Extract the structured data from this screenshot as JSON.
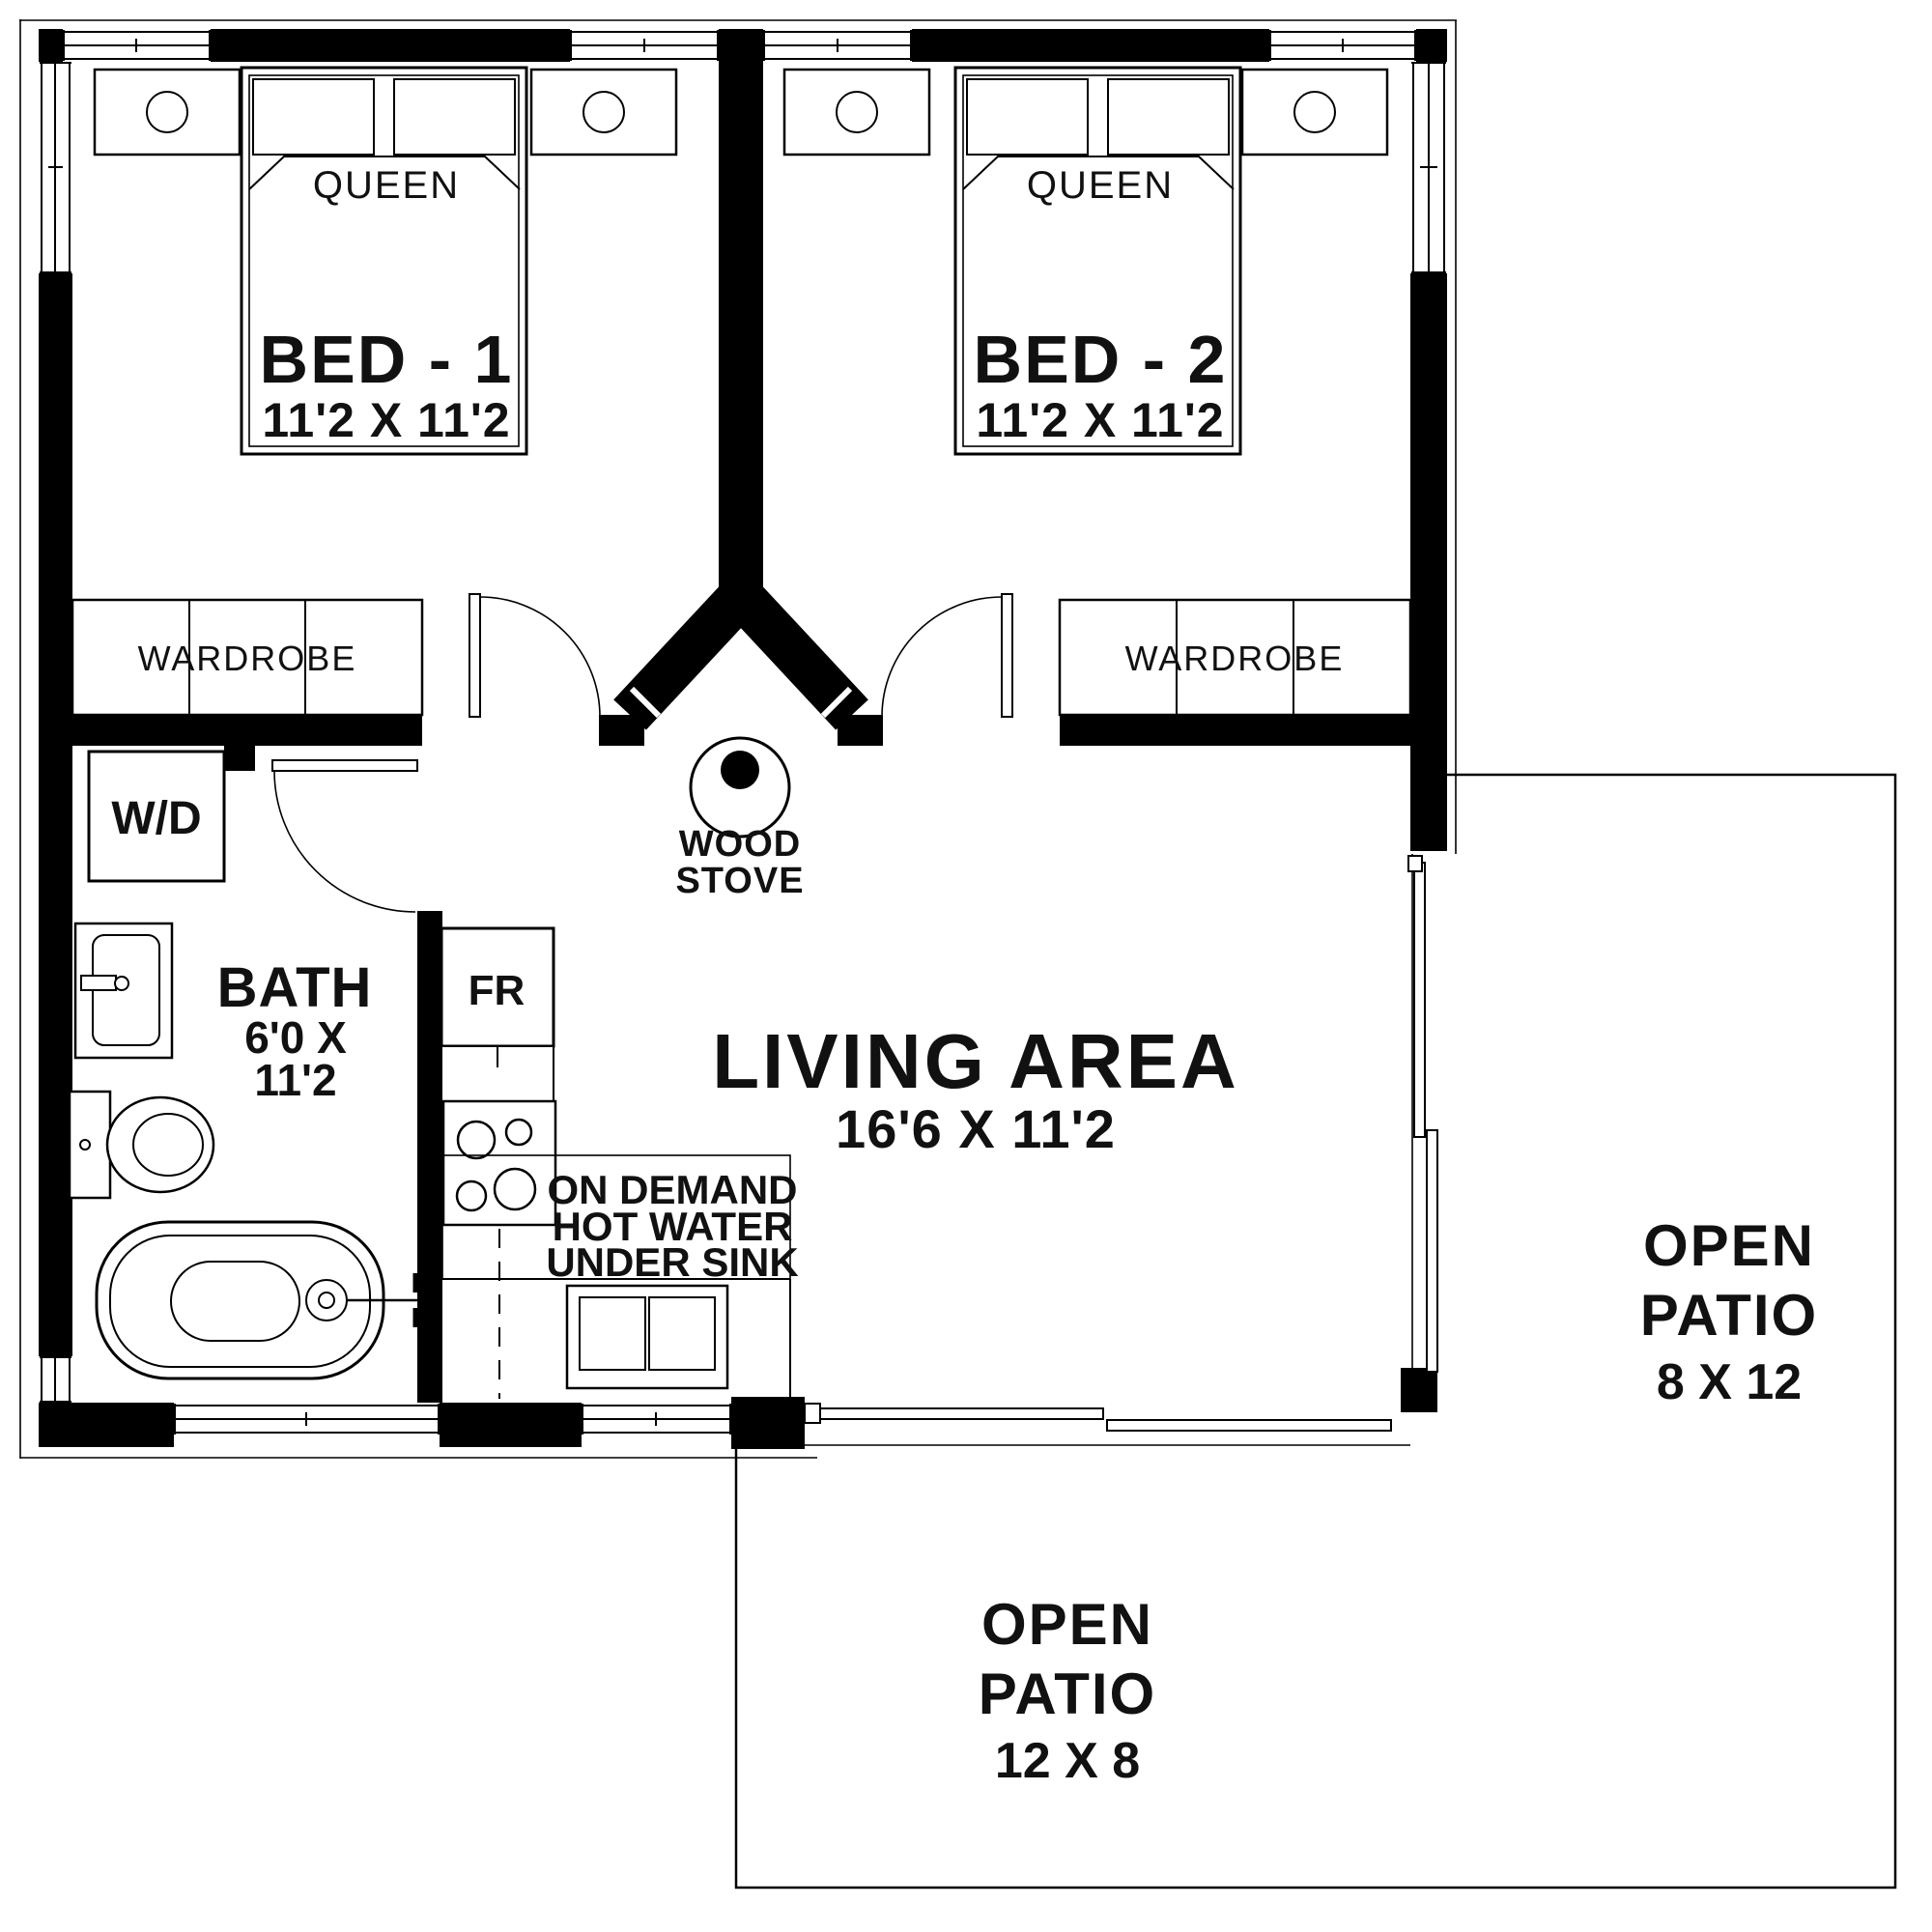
{
  "plan": {
    "bedroom1": {
      "label": "BED - 1",
      "dims": "11'2 X 11'2",
      "bed_type": "QUEEN",
      "wardrobe": "WARDROBE"
    },
    "bedroom2": {
      "label": "BED - 2",
      "dims": "11'2 X 11'2",
      "bed_type": "QUEEN",
      "wardrobe": "WARDROBE"
    },
    "bath": {
      "label": "BATH",
      "dims_line1": "6'0 X",
      "dims_line2": "11'2",
      "washer_dryer": "W/D"
    },
    "living": {
      "label": "LIVING AREA",
      "dims": "16'6 X 11'2"
    },
    "kitchen": {
      "fridge": "FR",
      "note_line1": "ON DEMAND",
      "note_line2": "HOT WATER",
      "note_line3": "UNDER SINK"
    },
    "wood_stove": {
      "line1": "WOOD",
      "line2": "STOVE"
    },
    "patio_right": {
      "line1": "OPEN",
      "line2": "PATIO",
      "dims": "8 X 12"
    },
    "patio_bottom": {
      "line1": "OPEN",
      "line2": "PATIO",
      "dims": "12 X 8"
    }
  },
  "colors": {
    "walls": "#000000",
    "lines": "#1a1a1a",
    "floor": "#ffffff"
  }
}
